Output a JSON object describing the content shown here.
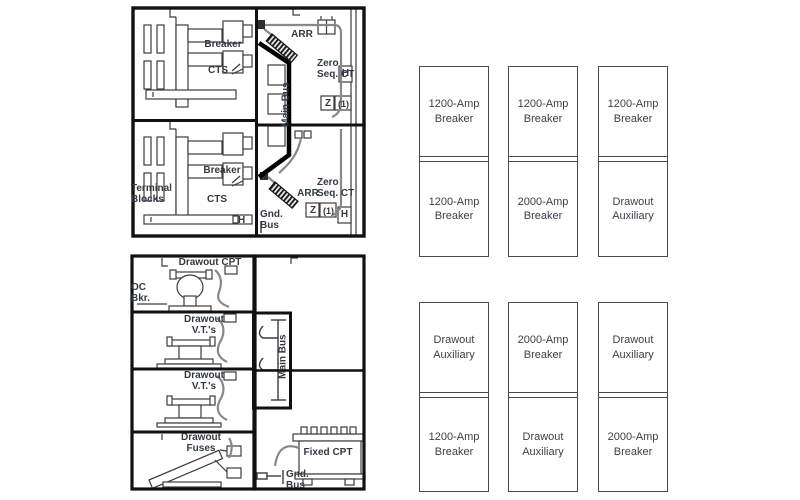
{
  "colors": {
    "line": "#3c3c3c",
    "thick_border": "#111111",
    "label_text": "#333a44",
    "plan_border": "#4a4a4a",
    "cable": "#888888"
  },
  "elevation_top": {
    "upper_front": {
      "breaker": "Breaker",
      "cts": "CTS"
    },
    "upper_rear": {
      "arr": "ARR",
      "zero_seq": "Zero Seq. CT",
      "h": "H",
      "z": "Z",
      "z_note": "(1)"
    },
    "bus": {
      "main_bus": "Main Bus"
    },
    "lower_front": {
      "terminal_blocks": "Terminal Blocks",
      "breaker": "Breaker",
      "cts": "CTS",
      "h": "H"
    },
    "lower_rear": {
      "arr": "ARR",
      "zero_seq": "Zero Seq. CT",
      "gnd_bus": "Gnd. Bus",
      "z": "Z",
      "z_note": "(1)",
      "h": "H"
    }
  },
  "elevation_bottom": {
    "compartments": {
      "drawout_cpt": "Drawout CPT",
      "oc_bkr": "OC Bkr.",
      "drawout_vts_upper": "Drawout V.T.'s",
      "drawout_vts_lower": "Drawout V.T.'s",
      "drawout_fuses": "Drawout Fuses"
    },
    "rear": {
      "main_bus": "Main Bus",
      "fixed_cpt": "Fixed CPT",
      "gnd_bus": "Gnd. Bus"
    }
  },
  "floor_plan": {
    "groups": [
      {
        "columns": [
          {
            "top": "1200-Amp Breaker",
            "bottom": "1200-Amp Breaker"
          },
          {
            "top": "1200-Amp Breaker",
            "bottom": "2000-Amp Breaker"
          },
          {
            "top": "1200-Amp Breaker",
            "bottom": "Drawout Auxiliary"
          }
        ]
      },
      {
        "columns": [
          {
            "top": "Drawout Auxiliary",
            "bottom": "1200-Amp Breaker"
          },
          {
            "top": "2000-Amp Breaker",
            "bottom": "Drawout Auxiliary"
          },
          {
            "top": "Drawout Auxiliary",
            "bottom": "2000-Amp Breaker"
          }
        ]
      }
    ]
  }
}
